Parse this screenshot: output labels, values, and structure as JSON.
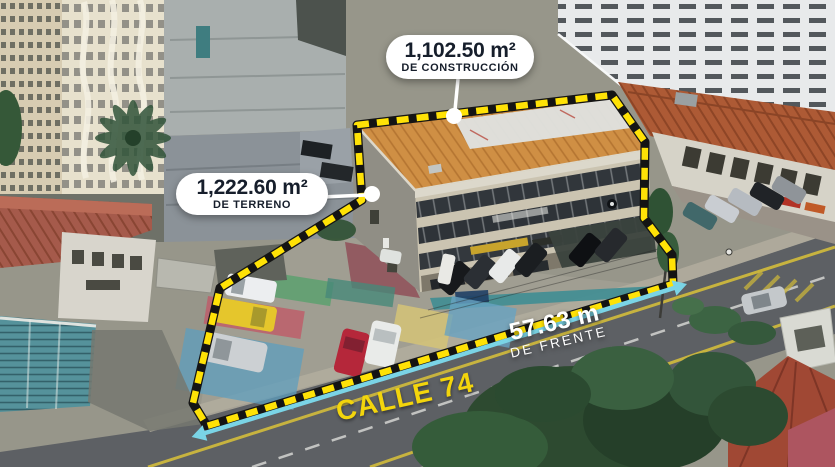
{
  "image": {
    "type": "aerial-property-marketing-photo",
    "width": 835,
    "height": 467
  },
  "labels": {
    "construction": {
      "value": "1,102.50 m²",
      "caption": "DE CONSTRUCCIÓN"
    },
    "land": {
      "value": "1,222.60 m²",
      "caption": "DE TERRENO"
    },
    "frontage": {
      "value": "57.63 m",
      "caption": "DE FRENTE"
    },
    "street": {
      "name": "CALLE 74"
    }
  },
  "colors": {
    "boundary": "#ffe206",
    "arrow": "#7ad4e6",
    "street_text": "#f3d50c",
    "label_bg": "#ffffff",
    "label_text": "#161e2b"
  }
}
